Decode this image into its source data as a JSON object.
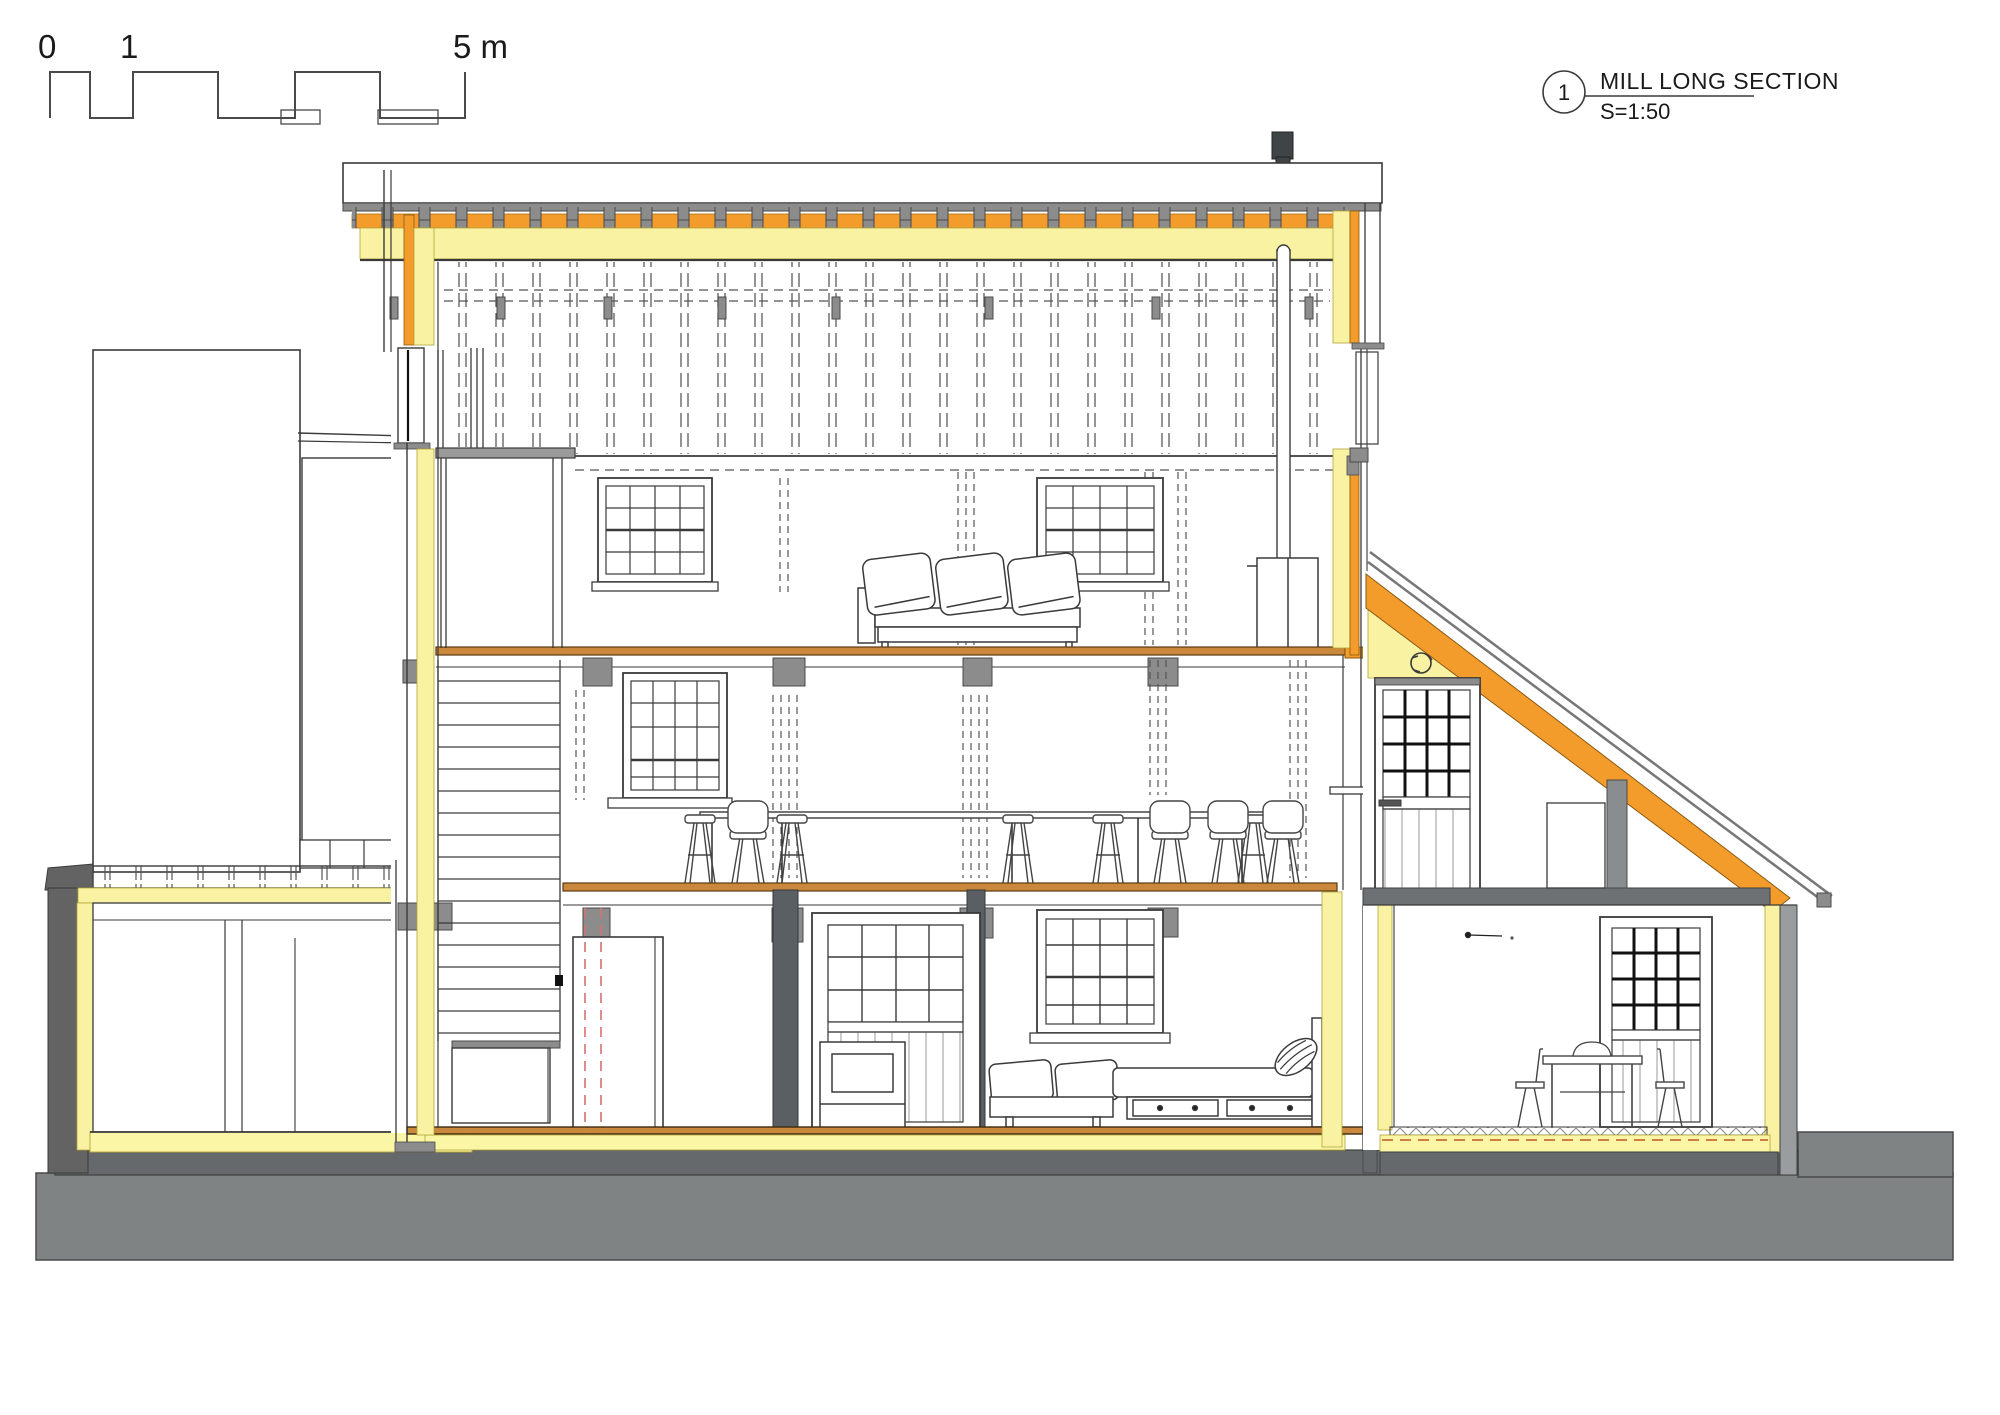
{
  "title_block": {
    "view_number": "1",
    "view_title": "MILL LONG SECTION",
    "view_scale": "S=1:50"
  },
  "scale_bar": {
    "label_0": "0",
    "label_1": "1",
    "label_5": "5 m",
    "total_meters": 5
  },
  "colors": {
    "insulation_soft_yellow": "#F8F2A2",
    "insulation_rigid_orange": "#F39C2C",
    "floor_timber_line": "#C9883B",
    "earth_gray": "#7F8383",
    "foundation_slab": "#66696B",
    "masonry_wall_dark": "#636363",
    "roof_gray": "#8C8C8C",
    "structure_post": "#5A5F63",
    "hidden_flue_red_dashed": "#D97070",
    "dpc_orange_dashed": "#C96F33",
    "chimney_dark": "#3F4547",
    "line_dark": "#3a3a3a"
  },
  "drawing": {
    "type": "building long section",
    "levels": [
      "roof void / attic",
      "second floor with sofa",
      "first floor with bar counter and stools",
      "ground floor with bed",
      "lean-to garden room"
    ],
    "depicted_elements": [
      "scale bar",
      "section title bubble",
      "chimney flue terminal",
      "roof insulation build-up",
      "rafter tails",
      "stair with treads and landing",
      "left annex with flat roof",
      "sash windows",
      "glazed doors",
      "stable door",
      "sofa with cushions",
      "bar counter",
      "bar stools",
      "chairs",
      "fridge cabinet",
      "stove",
      "bed with drawers and pillow",
      "flue cupboard",
      "dining table with bowl",
      "dining chairs",
      "ground and foundation slab",
      "damp proof course dashed line",
      "hidden flue red dashed lines",
      "detail reference circle"
    ]
  }
}
